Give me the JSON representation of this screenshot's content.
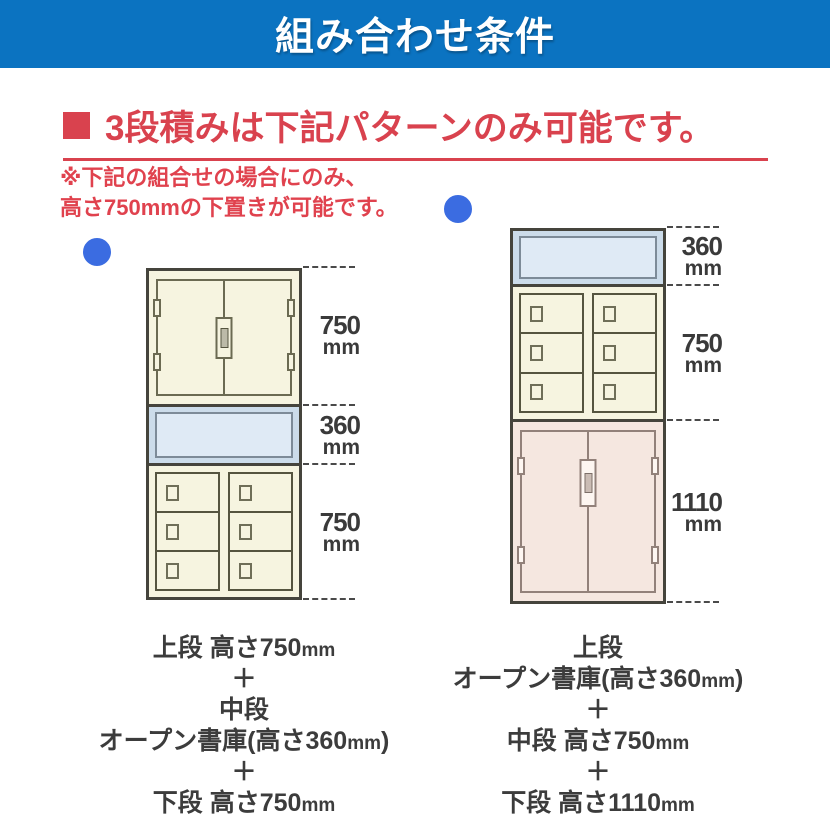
{
  "header": {
    "title": "組み合わせ条件"
  },
  "heading": {
    "text": "3段積みは下記パターンのみ可能です。"
  },
  "note": {
    "line1": "※下記の組合せの場合にのみ、",
    "line2": "高さ750mmの下置きが可能です。"
  },
  "left": {
    "dims": [
      {
        "value": "750",
        "unit": "mm"
      },
      {
        "value": "360",
        "unit": "mm"
      },
      {
        "value": "750",
        "unit": "mm"
      }
    ],
    "caption": [
      {
        "pre": "上段 高さ750",
        "unit": "mm",
        "post": ""
      },
      {
        "pre": "＋",
        "unit": "",
        "post": ""
      },
      {
        "pre": "中段",
        "unit": "",
        "post": ""
      },
      {
        "pre": "オープン書庫(高さ360",
        "unit": "mm",
        "post": ")"
      },
      {
        "pre": "＋",
        "unit": "",
        "post": ""
      },
      {
        "pre": "下段 高さ750",
        "unit": "mm",
        "post": ""
      }
    ]
  },
  "right": {
    "dims": [
      {
        "value": "360",
        "unit": "mm"
      },
      {
        "value": "750",
        "unit": "mm"
      },
      {
        "value": "1110",
        "unit": "mm"
      }
    ],
    "caption": [
      {
        "pre": "上段",
        "unit": "",
        "post": ""
      },
      {
        "pre": "オープン書庫(高さ360",
        "unit": "mm",
        "post": ")"
      },
      {
        "pre": "＋",
        "unit": "",
        "post": ""
      },
      {
        "pre": "中段 高さ750",
        "unit": "mm",
        "post": ""
      },
      {
        "pre": "＋",
        "unit": "",
        "post": ""
      },
      {
        "pre": "下段 高さ1110",
        "unit": "mm",
        "post": ""
      }
    ]
  },
  "colors": {
    "header_blue": "#0b73c1",
    "accent_red": "#d9424e",
    "marker_blue": "#3b6ce1",
    "cabinet_cream": "#f6f4e0",
    "shelf_blue_outer": "#ccdcea",
    "shelf_blue_inner": "#dfeaf5",
    "cabinet_pink": "#f5e7e0",
    "label_gray": "#3a3a3a"
  }
}
